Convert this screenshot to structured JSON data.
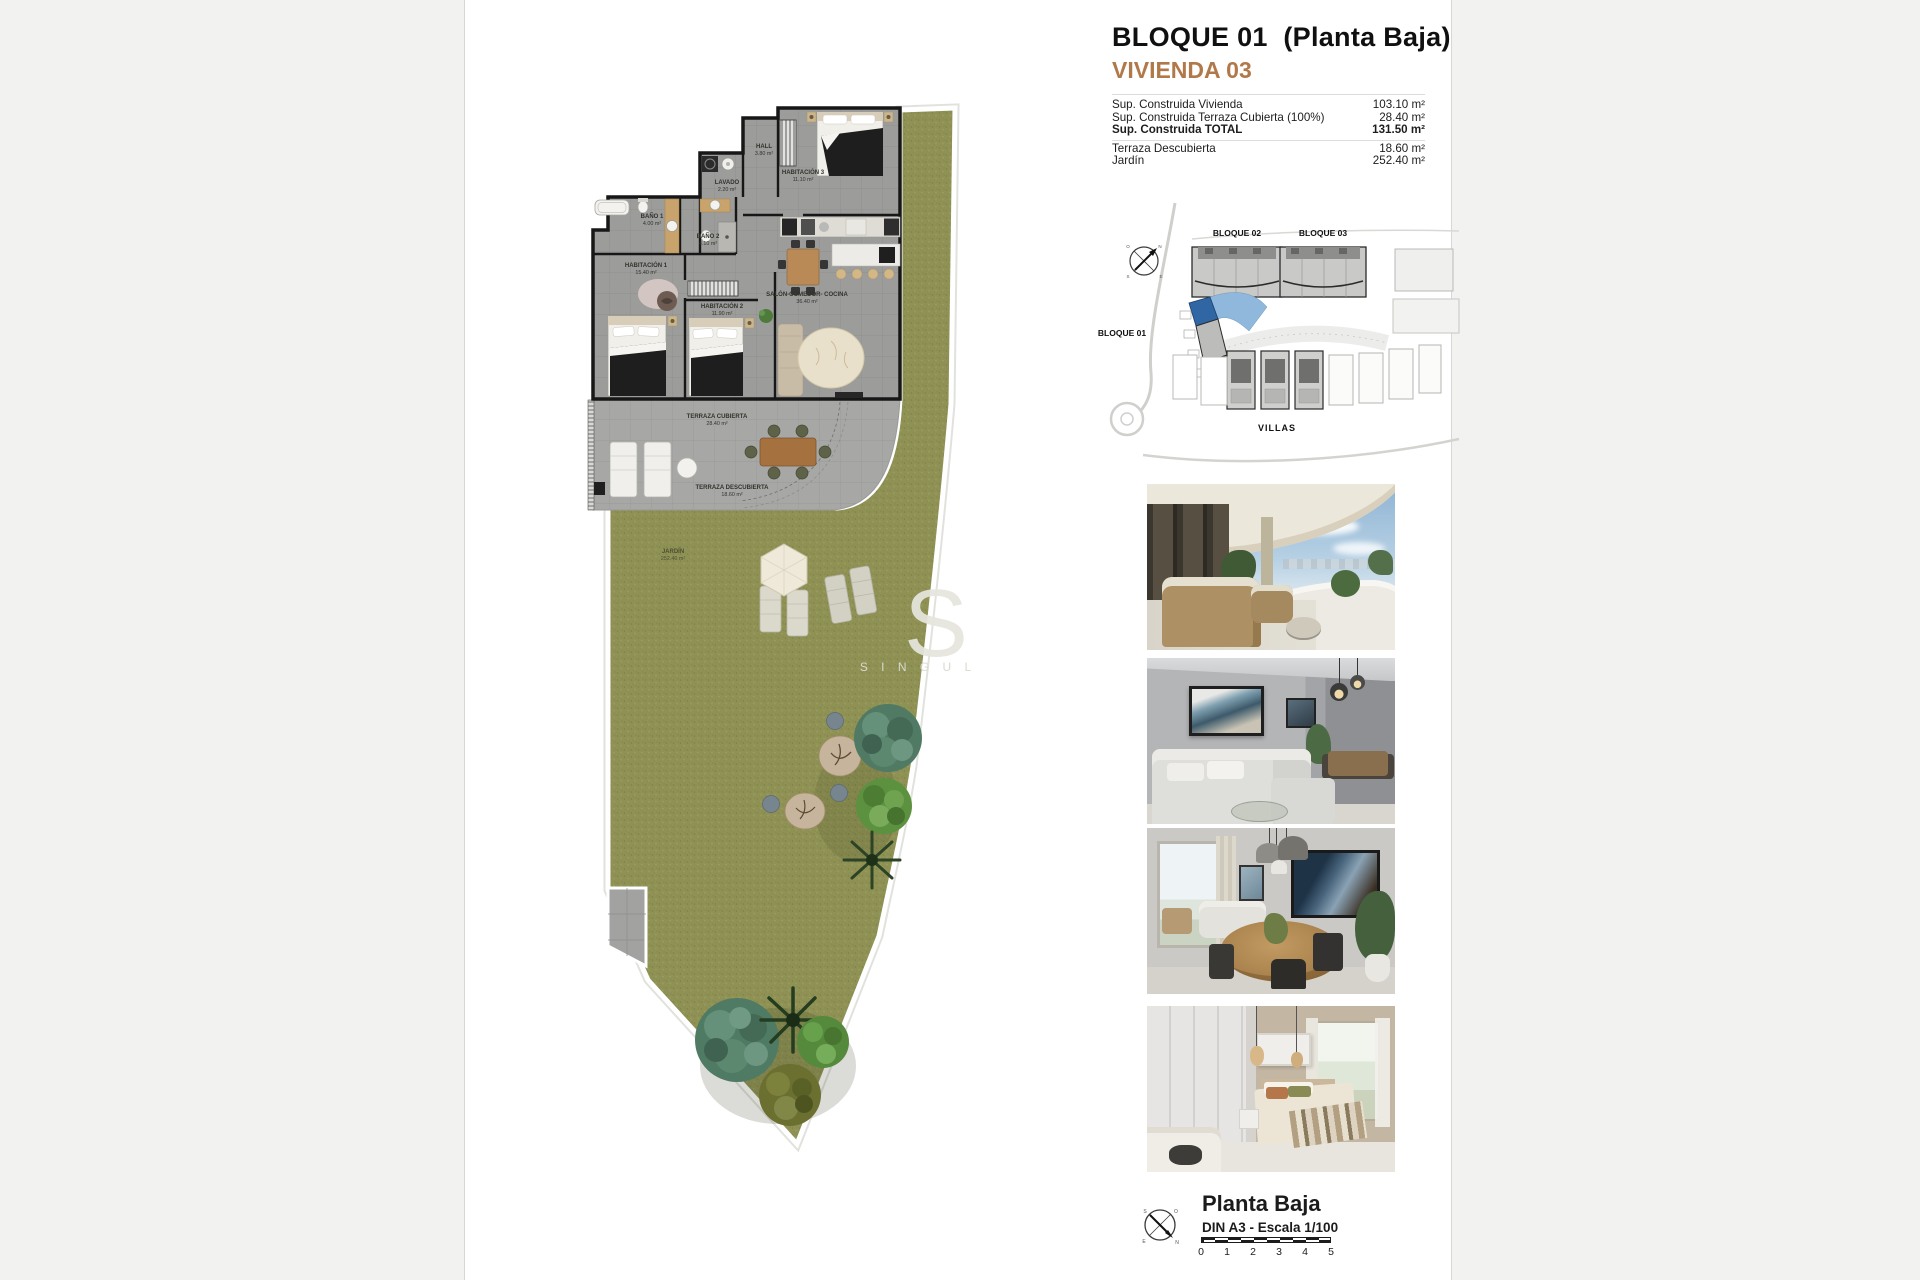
{
  "header": {
    "title": "BLOQUE 01  (Planta Baja)",
    "unit": "VIVIENDA 03",
    "accent_color": "#b1794a"
  },
  "surface_table": {
    "rows": [
      {
        "label": "Sup. Construida Vivienda",
        "value": "103.10 m²"
      },
      {
        "label": "Sup. Construida Terraza Cubierta (100%)",
        "value": "28.40 m²"
      },
      {
        "label": "Sup. Construida TOTAL",
        "value": "131.50 m²"
      },
      {
        "label": "Terraza Descubierta",
        "value": "18.60 m²"
      },
      {
        "label": "Jardín",
        "value": "252.40 m²"
      }
    ]
  },
  "floor_plan": {
    "rooms": [
      {
        "name": "HALL",
        "area": "3.80 m²"
      },
      {
        "name": "LAVADO",
        "area": "2.20 m²"
      },
      {
        "name": "HABITACIÓN 3",
        "area": "11.10 m²"
      },
      {
        "name": "BAÑO 1",
        "area": "4.00 m²"
      },
      {
        "name": "BAÑO 2",
        "area": "4.10 m²"
      },
      {
        "name": "HABITACIÓN 1",
        "area": "15.40 m²"
      },
      {
        "name": "HABITACIÓN 2",
        "area": "11.90 m²"
      },
      {
        "name": "SALÓN-COMEDOR- COCINA",
        "area": "36.40 m²"
      },
      {
        "name": "TERRAZA CUBIERTA",
        "area": "28.40 m²"
      },
      {
        "name": "TERRAZA DESCUBIERTA",
        "area": "18.60 m²"
      },
      {
        "name": "JARDÍN",
        "area": "252.40 m²"
      }
    ],
    "watermark": {
      "initial": "S",
      "text": "S I N G U L"
    },
    "grass_color": "#8f9254"
  },
  "site_plan": {
    "labels": {
      "bloque01": "BLOQUE 01",
      "bloque02": "BLOQUE 02",
      "bloque03": "BLOQUE 03",
      "villas": "VILLAS"
    },
    "compass": {
      "n": "N",
      "s": "S",
      "e": "E",
      "o": "O"
    },
    "highlight": {
      "unit_color": "#2f66a3",
      "garden_color": "#8fb8dc"
    }
  },
  "photos": [
    {
      "name": "terrace-exterior"
    },
    {
      "name": "living-room"
    },
    {
      "name": "dining-area"
    },
    {
      "name": "bedroom"
    }
  ],
  "footer": {
    "title": "Planta Baja",
    "scale_label": "DIN A3 - Escala 1/100",
    "scale_ticks": [
      "0",
      "1",
      "2",
      "3",
      "4",
      "5"
    ],
    "compass": {
      "n": "N",
      "s": "S",
      "e": "E",
      "o": "O"
    }
  }
}
